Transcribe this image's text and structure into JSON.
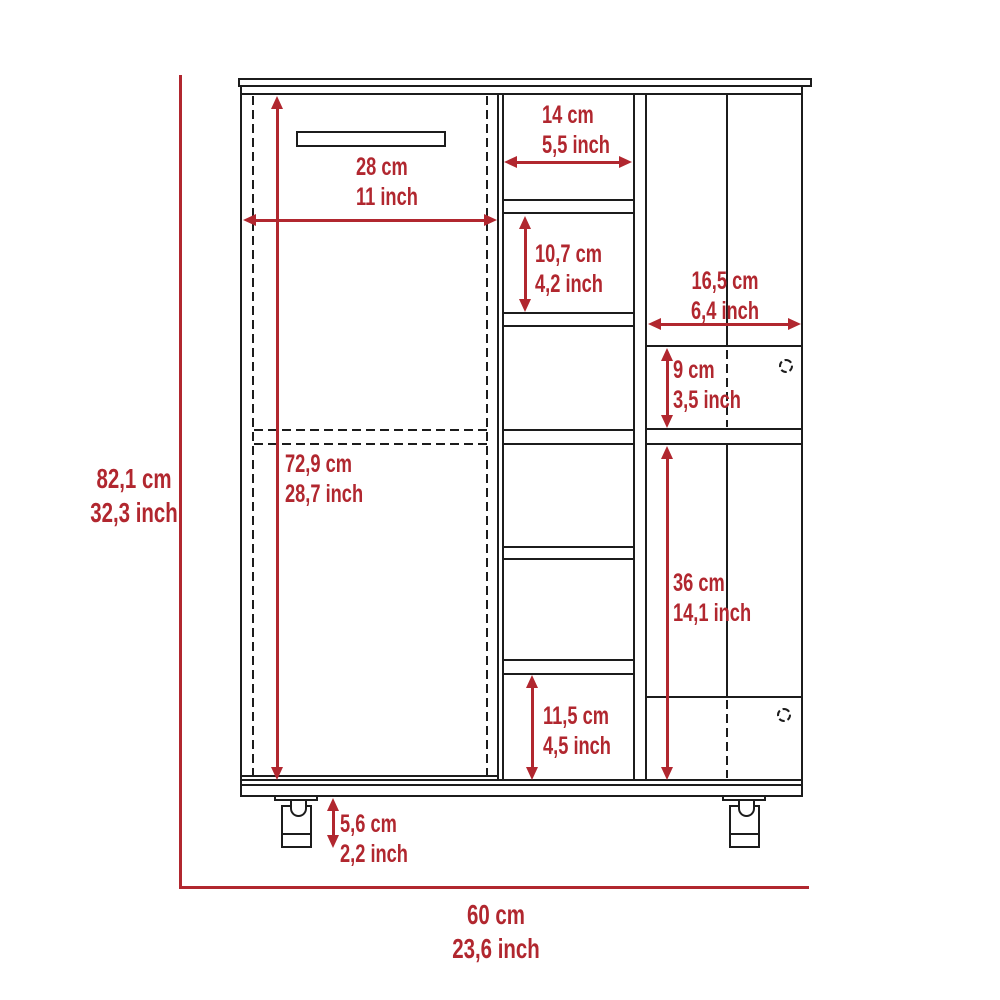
{
  "diagram": {
    "type": "furniture-dimension-diagram",
    "subject": "bar-cart-cabinet-front-view",
    "colors": {
      "dimension_red": "#B1272F",
      "line_black": "#1C1C1C",
      "background": "#FFFFFF"
    },
    "dimensions": {
      "overall_height": {
        "cm": "82,1 cm",
        "inch": "32,3 inch"
      },
      "overall_width": {
        "cm": "60 cm",
        "inch": "23,6 inch"
      },
      "left_door_width": {
        "cm": "28 cm",
        "inch": "11 inch"
      },
      "left_door_height": {
        "cm": "72,9 cm",
        "inch": "28,7 inch"
      },
      "cubby_width": {
        "cm": "14 cm",
        "inch": "5,5 inch"
      },
      "cubby_height": {
        "cm": "10,7 cm",
        "inch": "4,2 inch"
      },
      "right_section_width": {
        "cm": "16,5 cm",
        "inch": "6,4 inch"
      },
      "small_compartment_height": {
        "cm": "9 cm",
        "inch": "3,5 inch"
      },
      "lower_door_height": {
        "cm": "36 cm",
        "inch": "14,1 inch"
      },
      "bottom_cubby_height": {
        "cm": "11,5 cm",
        "inch": "4,5 inch"
      },
      "caster_height": {
        "cm": "5,6 cm",
        "inch": "2,2 inch"
      }
    }
  }
}
